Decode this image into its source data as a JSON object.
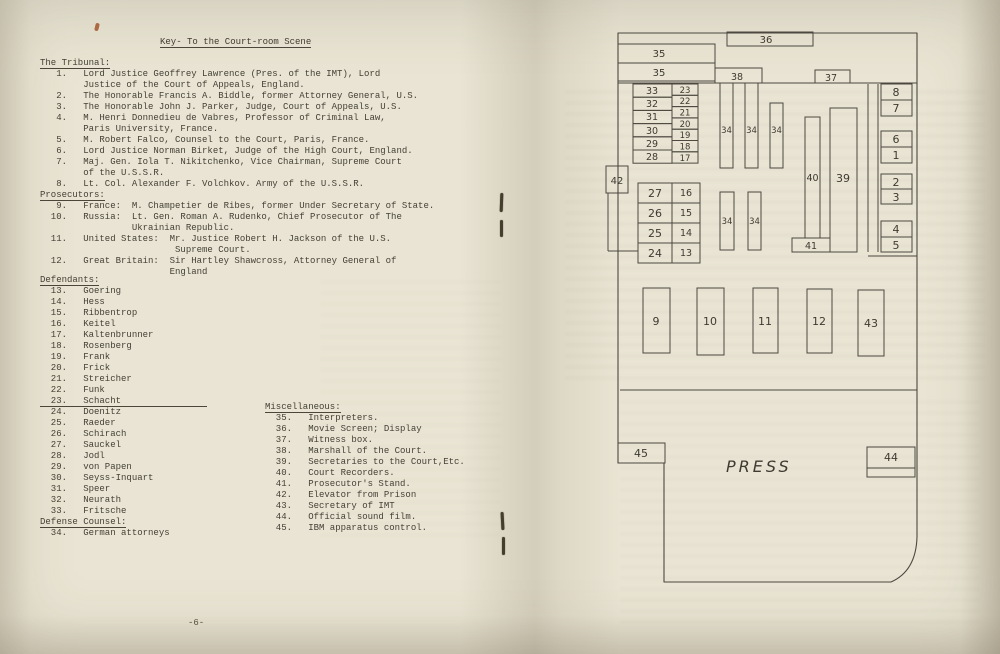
{
  "left_page": {
    "title": "Key- To the Court-room Scene",
    "tribunal_heading": "The Tribunal:",
    "tribunal_lines": [
      "   1.   Lord Justice Geoffrey Lawrence (Pres. of the IMT), Lord",
      "        Justice of the Court of Appeals, England.",
      "   2.   The Honorable Francis A. Biddle, former Attorney General, U.S.",
      "   3.   The Honorable John J. Parker, Judge, Court of Appeals, U.S.",
      "   4.   M. Henri Donnedieu de Vabres, Professor of Criminal Law,",
      "        Paris University, France.",
      "   5.   M. Robert Falco, Counsel to the Court, Paris, France.",
      "   6.   Lord Justice Norman Birket, Judge of the High Court, England.",
      "   7.   Maj. Gen. Iola T. Nikitchenko, Vice Chairman, Supreme Court",
      "        of the U.S.S.R.",
      "   8.   Lt. Col. Alexander F. Volchkov. Army of the U.S.S.R."
    ],
    "prosecutors_heading": "Prosecutors:",
    "prosecutors_lines": [
      "   9.   France:  M. Champetier de Ribes, former Under Secretary of State.",
      "  10.   Russia:  Lt. Gen. Roman A. Rudenko, Chief Prosecutor of The",
      "                 Ukrainian Republic.",
      "  11.   United States:  Mr. Justice Robert H. Jackson of the U.S.",
      "                         Supreme Court.",
      "  12.   Great Britain:  Sir Hartley Shawcross, Attorney General of",
      "                        England"
    ],
    "defendants_heading": "Defendants:",
    "defendants_lines": [
      "  13.   Goering",
      "  14.   Hess",
      "  15.   Ribbentrop",
      "  16.   Keitel",
      "  17.   Kaltenbrunner",
      "  18.   Rosenberg",
      "  19.   Frank",
      "  20.   Frick",
      "  21.   Streicher",
      "  22.   Funk",
      {
        "text": "  23.   Schacht                ",
        "u": true
      },
      "  24.   Doenitz",
      "  25.   Raeder",
      "  26.   Schirach",
      "  27.   Sauckel",
      "  28.   Jodl",
      "  29.   von Papen",
      "  30.   Seyss-Inquart",
      "  31.   Speer",
      "  32.   Neurath",
      "  33.   Fritsche"
    ],
    "defense_heading": "Defense Counsel:",
    "defense_lines": [
      "  34.   German attorneys"
    ],
    "misc_heading": "Miscellaneous:",
    "misc_lines": [
      "  35.   Interpreters.",
      "  36.   Movie Screen; Display",
      "  37.   Witness box.",
      "  38.   Marshall of the Court.",
      "  39.   Secretaries to the Court,Etc.",
      "  40.   Court Recorders.",
      "  41.   Prosecutor's Stand.",
      "  42.   Elevator from Prison",
      "  43.   Secretary of IMT",
      "  44.   Official sound film.",
      "  45.   IBM apparatus control."
    ],
    "page_number": "-6-"
  },
  "diagram": {
    "stroke": "#4c4840",
    "outline": "M618,33 L917,33 L917,537 Q916,571 891,582 L664,582 L664,463 L618,463 Z",
    "lines": [
      [
        618,
        83,
        917,
        83
      ],
      [
        620,
        390,
        917,
        390
      ],
      [
        868,
        84,
        868,
        252
      ],
      [
        878,
        84,
        878,
        252
      ],
      [
        868,
        256,
        917,
        256
      ],
      [
        608,
        193,
        608,
        251
      ],
      [
        608,
        251,
        638,
        251
      ]
    ],
    "rects": [
      {
        "x": 727,
        "y": 32,
        "w": 86,
        "h": 14,
        "l": "36",
        "lx": 766,
        "ly": 43,
        "fs": 10
      },
      {
        "x": 618,
        "y": 44,
        "w": 97,
        "h": 19,
        "l": "35",
        "lx": 659,
        "ly": 57,
        "fs": 10
      },
      {
        "x": 618,
        "y": 63,
        "w": 97,
        "h": 18,
        "l": "35",
        "lx": 659,
        "ly": 76,
        "fs": 10
      },
      {
        "x": 715,
        "y": 68,
        "w": 47,
        "h": 15,
        "l": "38",
        "lx": 737,
        "ly": 80,
        "fs": 9.5
      },
      {
        "x": 815,
        "y": 70,
        "w": 35,
        "h": 13,
        "l": "37",
        "lx": 831,
        "ly": 81,
        "fs": 9.5
      },
      {
        "x": 606,
        "y": 166,
        "w": 22,
        "h": 27,
        "l": "42",
        "lx": 617,
        "ly": 184,
        "fs": 10
      },
      {
        "x": 633,
        "y": 84,
        "w": 39,
        "h": 13.2,
        "l": "33",
        "lx": 652,
        "ly": 94,
        "fs": 9.5
      },
      {
        "x": 633,
        "y": 97.2,
        "w": 39,
        "h": 13.2,
        "l": "32",
        "lx": 652,
        "ly": 107,
        "fs": 9.5
      },
      {
        "x": 633,
        "y": 110.4,
        "w": 39,
        "h": 13.2,
        "l": "31",
        "lx": 652,
        "ly": 120,
        "fs": 9.5
      },
      {
        "x": 633,
        "y": 123.6,
        "w": 39,
        "h": 13.2,
        "l": "30",
        "lx": 652,
        "ly": 134,
        "fs": 9.5
      },
      {
        "x": 633,
        "y": 136.8,
        "w": 39,
        "h": 13.2,
        "l": "29",
        "lx": 652,
        "ly": 147,
        "fs": 9.5
      },
      {
        "x": 633,
        "y": 150,
        "w": 39,
        "h": 13.2,
        "l": "28",
        "lx": 652,
        "ly": 160,
        "fs": 9.5
      },
      {
        "x": 672,
        "y": 84,
        "w": 26,
        "h": 11.3,
        "l": "23",
        "lx": 685,
        "ly": 93,
        "fs": 8.5
      },
      {
        "x": 672,
        "y": 95.3,
        "w": 26,
        "h": 11.3,
        "l": "22",
        "lx": 685,
        "ly": 104,
        "fs": 8.5
      },
      {
        "x": 672,
        "y": 106.6,
        "w": 26,
        "h": 11.3,
        "l": "21",
        "lx": 685,
        "ly": 115.5,
        "fs": 8.5
      },
      {
        "x": 672,
        "y": 117.9,
        "w": 26,
        "h": 11.3,
        "l": "20",
        "lx": 685,
        "ly": 127,
        "fs": 8.5
      },
      {
        "x": 672,
        "y": 129.2,
        "w": 26,
        "h": 11.3,
        "l": "19",
        "lx": 685,
        "ly": 138,
        "fs": 8.5
      },
      {
        "x": 672,
        "y": 140.5,
        "w": 26,
        "h": 11.3,
        "l": "18",
        "lx": 685,
        "ly": 149.5,
        "fs": 8.5
      },
      {
        "x": 672,
        "y": 151.8,
        "w": 26,
        "h": 11.3,
        "l": "17",
        "lx": 685,
        "ly": 161,
        "fs": 8.5
      },
      {
        "x": 638,
        "y": 183,
        "w": 34,
        "h": 20,
        "l": "27",
        "lx": 655,
        "ly": 197,
        "fs": 11
      },
      {
        "x": 638,
        "y": 203,
        "w": 34,
        "h": 20,
        "l": "26",
        "lx": 655,
        "ly": 217,
        "fs": 11
      },
      {
        "x": 638,
        "y": 223,
        "w": 34,
        "h": 20,
        "l": "25",
        "lx": 655,
        "ly": 237,
        "fs": 11
      },
      {
        "x": 638,
        "y": 243,
        "w": 34,
        "h": 20,
        "l": "24",
        "lx": 655,
        "ly": 257,
        "fs": 11
      },
      {
        "x": 672,
        "y": 183,
        "w": 28,
        "h": 20,
        "l": "16",
        "lx": 686,
        "ly": 196,
        "fs": 9.5
      },
      {
        "x": 672,
        "y": 203,
        "w": 28,
        "h": 20,
        "l": "15",
        "lx": 686,
        "ly": 216,
        "fs": 9.5
      },
      {
        "x": 672,
        "y": 223,
        "w": 28,
        "h": 20,
        "l": "14",
        "lx": 686,
        "ly": 236,
        "fs": 9.5
      },
      {
        "x": 672,
        "y": 243,
        "w": 28,
        "h": 20,
        "l": "13",
        "lx": 686,
        "ly": 256,
        "fs": 9.5
      },
      {
        "x": 720,
        "y": 83,
        "w": 13,
        "h": 85,
        "l": "34",
        "lx": 726.5,
        "ly": 133,
        "fs": 8.5
      },
      {
        "x": 745,
        "y": 83,
        "w": 13,
        "h": 85,
        "l": "34",
        "lx": 751.5,
        "ly": 133,
        "fs": 8.5
      },
      {
        "x": 770,
        "y": 103,
        "w": 13,
        "h": 65,
        "l": "34",
        "lx": 776.5,
        "ly": 133,
        "fs": 8.5
      },
      {
        "x": 720,
        "y": 192,
        "w": 14,
        "h": 58,
        "l": "34",
        "lx": 727,
        "ly": 224,
        "fs": 8.5
      },
      {
        "x": 748,
        "y": 192,
        "w": 13,
        "h": 58,
        "l": "34",
        "lx": 754.5,
        "ly": 224,
        "fs": 8.5
      },
      {
        "x": 805,
        "y": 117,
        "w": 15,
        "h": 121,
        "l": "40",
        "lx": 812.5,
        "ly": 181,
        "fs": 9.5
      },
      {
        "x": 830,
        "y": 108,
        "w": 27,
        "h": 144,
        "l": "39",
        "lx": 843,
        "ly": 182,
        "fs": 11
      },
      {
        "x": 792,
        "y": 238,
        "w": 38,
        "h": 14,
        "l": "41",
        "lx": 811,
        "ly": 249,
        "fs": 9.5
      },
      {
        "x": 881,
        "y": 84,
        "w": 31,
        "h": 16,
        "l": "8",
        "lx": 896,
        "ly": 96,
        "fs": 11
      },
      {
        "x": 881,
        "y": 100,
        "w": 31,
        "h": 16,
        "l": "7",
        "lx": 896,
        "ly": 112,
        "fs": 11
      },
      {
        "x": 881,
        "y": 131,
        "w": 31,
        "h": 16,
        "l": "6",
        "lx": 896,
        "ly": 143,
        "fs": 11
      },
      {
        "x": 881,
        "y": 147,
        "w": 31,
        "h": 16,
        "l": "1",
        "lx": 896,
        "ly": 159,
        "fs": 11
      },
      {
        "x": 881,
        "y": 174,
        "w": 31,
        "h": 15,
        "l": "2",
        "lx": 896,
        "ly": 186,
        "fs": 11
      },
      {
        "x": 881,
        "y": 189,
        "w": 31,
        "h": 15,
        "l": "3",
        "lx": 896,
        "ly": 201,
        "fs": 11
      },
      {
        "x": 881,
        "y": 221,
        "w": 31,
        "h": 16,
        "l": "4",
        "lx": 896,
        "ly": 233,
        "fs": 11
      },
      {
        "x": 881,
        "y": 237,
        "w": 31,
        "h": 15,
        "l": "5",
        "lx": 896,
        "ly": 249,
        "fs": 11
      },
      {
        "x": 643,
        "y": 288,
        "w": 27,
        "h": 65,
        "l": "9",
        "lx": 656,
        "ly": 325,
        "fs": 11
      },
      {
        "x": 697,
        "y": 288,
        "w": 27,
        "h": 67,
        "l": "10",
        "lx": 710,
        "ly": 325,
        "fs": 11
      },
      {
        "x": 753,
        "y": 288,
        "w": 25,
        "h": 65,
        "l": "11",
        "lx": 765,
        "ly": 325,
        "fs": 11
      },
      {
        "x": 807,
        "y": 289,
        "w": 25,
        "h": 64,
        "l": "12",
        "lx": 819,
        "ly": 325,
        "fs": 11
      },
      {
        "x": 858,
        "y": 290,
        "w": 26,
        "h": 66,
        "l": "43",
        "lx": 871,
        "ly": 327,
        "fs": 11
      },
      {
        "x": 618,
        "y": 443,
        "w": 47,
        "h": 20,
        "l": "45",
        "lx": 641,
        "ly": 457,
        "fs": 11
      },
      {
        "x": 867,
        "y": 447,
        "w": 48,
        "h": 21,
        "l": "44",
        "lx": 891,
        "ly": 461,
        "fs": 11
      },
      {
        "x": 867,
        "y": 468,
        "w": 48,
        "h": 9,
        "l": "",
        "lx": 0,
        "ly": 0,
        "fs": 10
      }
    ],
    "press_label": {
      "text": "PRESS",
      "x": 726,
      "y": 472
    }
  }
}
